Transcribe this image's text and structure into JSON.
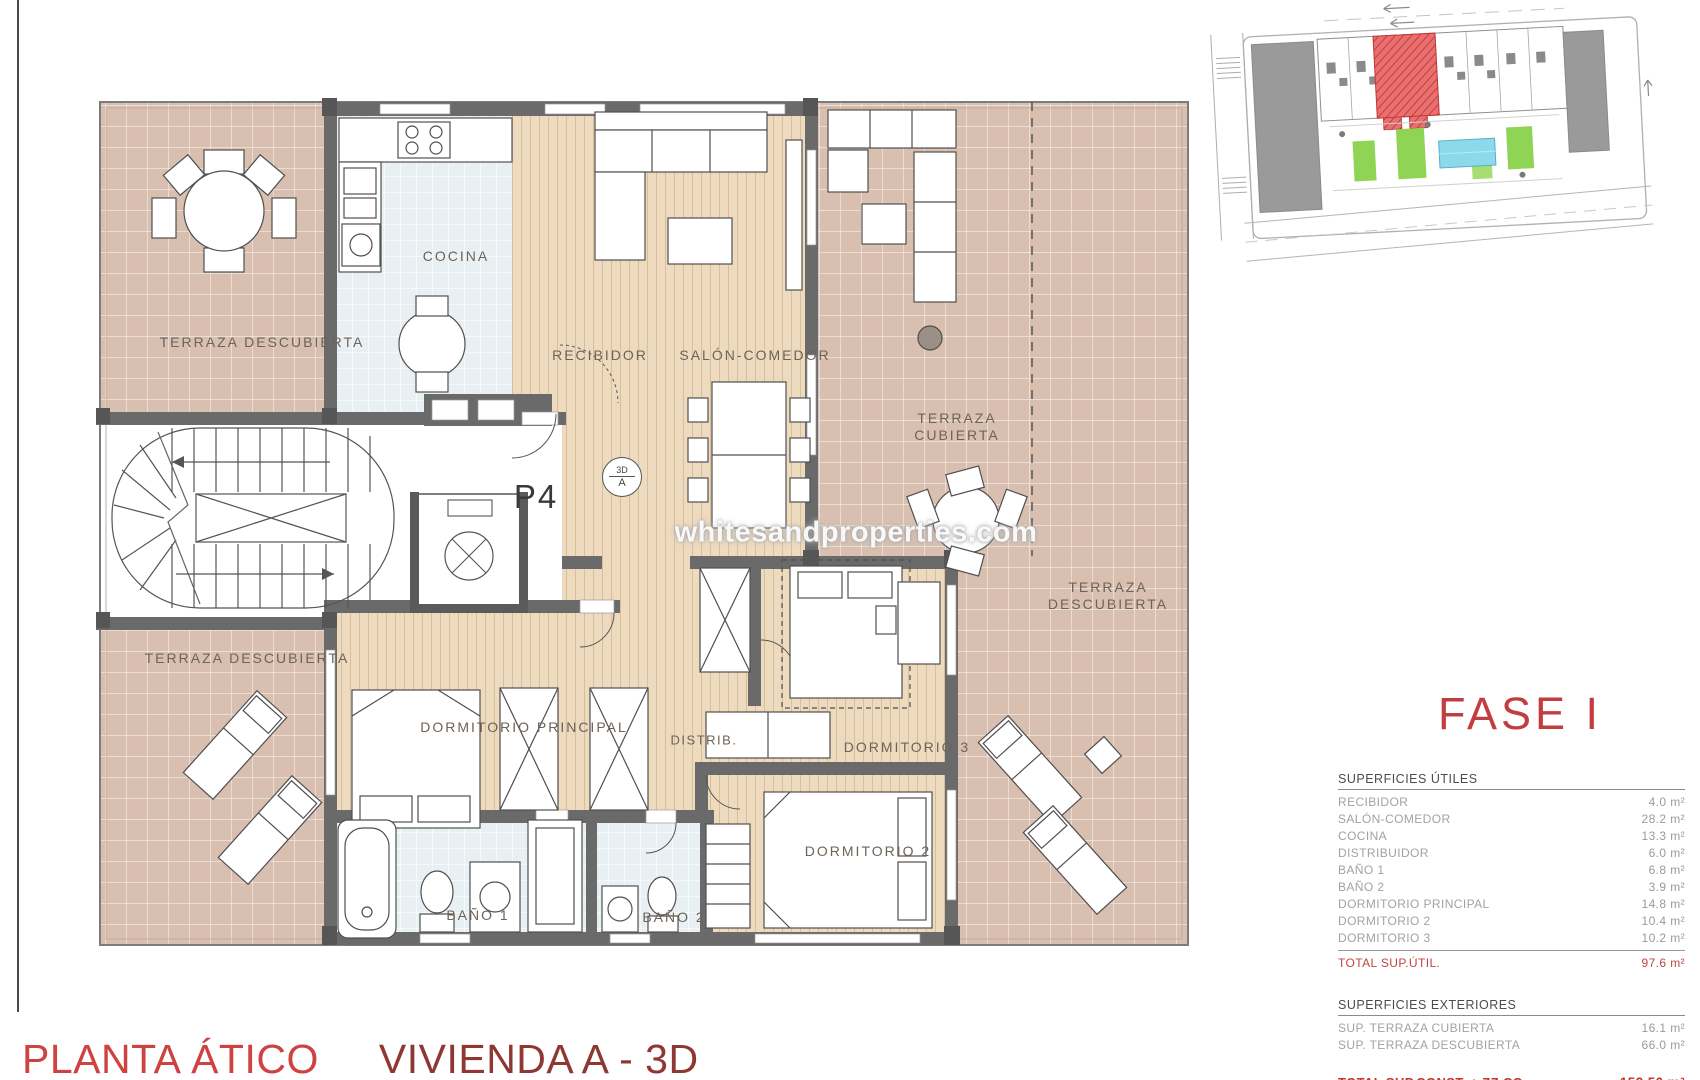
{
  "page": {
    "bottom_title": {
      "left": "PLANTA ÁTICO",
      "right": "VIVIENDA A - 3D"
    },
    "watermark": "whitesandproperties.com",
    "colors": {
      "accent_red": "#c23d3f",
      "dark_red": "#8f3833",
      "wall_gray": "#6a6a6a",
      "terrace_tile": "#d9bfb0",
      "wood_floor": "#eedbbf",
      "bath_tile": "#e9f0f4",
      "pool_blue": "#8bd9ea",
      "garden_green": "#90d455",
      "site_highlight": "#e25555"
    }
  },
  "floorplan": {
    "unit_label": "P4",
    "direction_symbol": {
      "top": "3D",
      "bottom": "A"
    },
    "rooms": {
      "terraza_descubierta_top": "TERRAZA DESCUBIERTA",
      "cocina": "COCINA",
      "recibidor": "RECIBIDOR",
      "salon_comedor": "SALÓN-COMEDOR",
      "terraza_cubierta": {
        "line1": "TERRAZA",
        "line2": "CUBIERTA"
      },
      "terraza_descubierta_right": {
        "line1": "TERRAZA",
        "line2": "DESCUBIERTA"
      },
      "terraza_descubierta_bottom": "TERRAZA DESCUBIERTA",
      "dormitorio_principal": "DORMITORIO PRINCIPAL",
      "distribuidor": "DISTRIB.",
      "dormitorio_3": "DORMITORIO 3",
      "dormitorio_2": "DORMITORIO 2",
      "bano_1": "BAÑO 1",
      "bano_2": "BAÑO 2"
    }
  },
  "sidebar": {
    "phase_title": "FASE I",
    "superficies_utiles": {
      "header": "SUPERFICIES ÚTILES",
      "rows": [
        {
          "label": "RECIBIDOR",
          "value": "4.0 m²"
        },
        {
          "label": "SALÓN-COMEDOR",
          "value": "28.2 m²"
        },
        {
          "label": "COCINA",
          "value": "13.3 m²"
        },
        {
          "label": "DISTRIBUIDOR",
          "value": "6.0 m²"
        },
        {
          "label": "BAÑO 1",
          "value": "6.8 m²"
        },
        {
          "label": "BAÑO 2",
          "value": "3.9 m²"
        },
        {
          "label": "DORMITORIO PRINCIPAL",
          "value": "14.8 m²"
        },
        {
          "label": "DORMITORIO 2",
          "value": "10.4 m²"
        },
        {
          "label": "DORMITORIO 3",
          "value": "10.2 m²"
        }
      ],
      "total": {
        "label": "TOTAL SUP.ÚTIL.",
        "value": "97.6 m²"
      }
    },
    "superficies_exteriores": {
      "header": "SUPERFICIES EXTERIORES",
      "rows": [
        {
          "label": "SUP. TERRAZA CUBIERTA",
          "value": "16.1 m²"
        },
        {
          "label": "SUP. TERRAZA DESCUBIERTA",
          "value": "66.0 m²"
        }
      ],
      "total": {
        "label": "TOTAL SUP.CONST. + ZZ.CC.",
        "value": "152.50 m²"
      }
    }
  }
}
